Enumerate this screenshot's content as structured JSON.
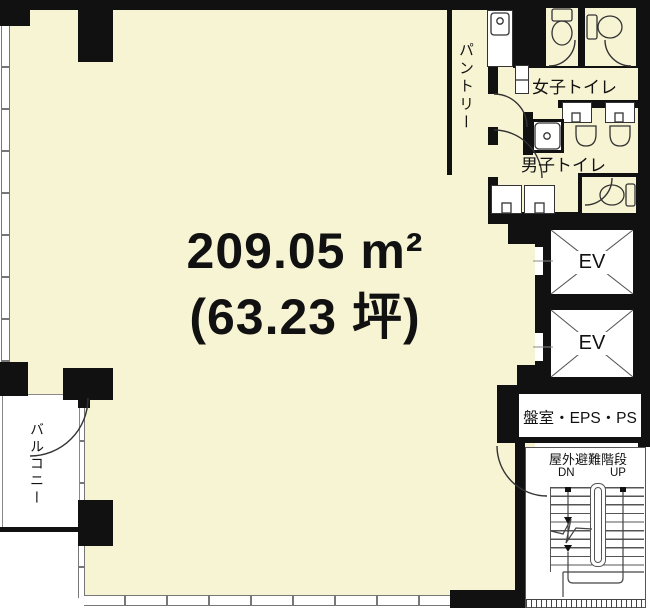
{
  "plan": {
    "area": {
      "value": "209.05 m²",
      "tsubo": "(63.23 坪)"
    },
    "labels": {
      "pantry": "パントリー",
      "womens_toilet": "女子トイレ",
      "mens_toilet": "男子トイレ",
      "balcony": "バルコニー",
      "panel_room": "盤室・EPS・PS",
      "outdoor_stairs": "屋外避難階段",
      "down": "DN",
      "up": "UP"
    },
    "elevators": [
      {
        "label": "EV"
      },
      {
        "label": "EV"
      }
    ],
    "colors": {
      "floor_fill": "#f7f4d4",
      "wall": "#111111",
      "exterior": "#ffffff",
      "line": "#333333"
    }
  }
}
